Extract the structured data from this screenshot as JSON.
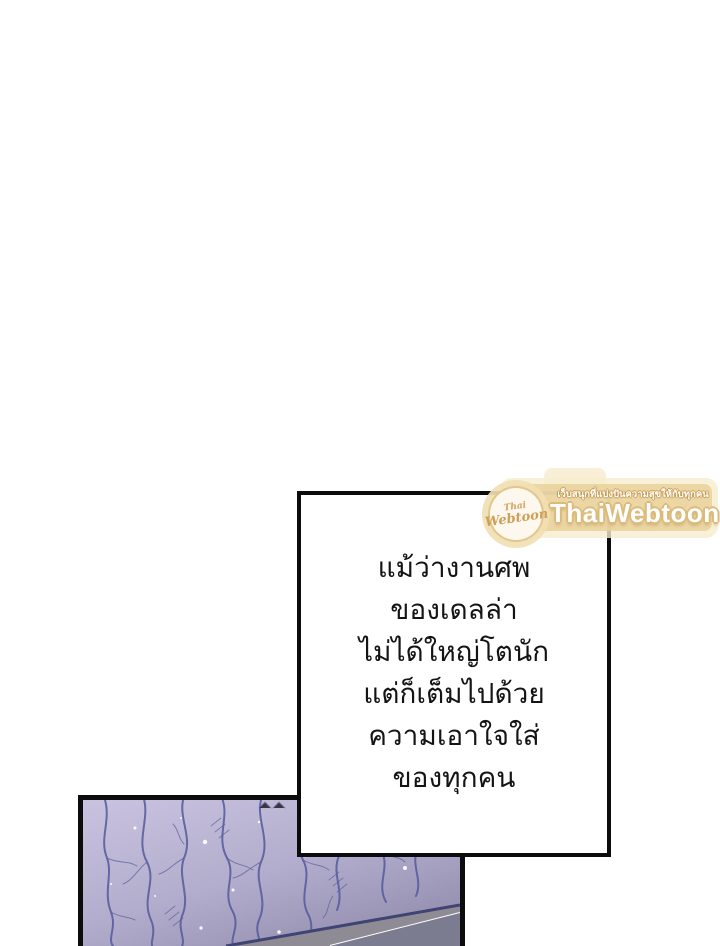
{
  "page": {
    "background_color": "#ffffff",
    "panel_border_color": "#0c0c0c"
  },
  "speech_box": {
    "lines": [
      "แม้ว่างานศพ",
      "ของเดลล่า",
      "ไม่ได้ใหญ่โตนัก",
      "แต่ก็เต็มไปด้วย",
      "ความเอาใจใส่",
      "ของทุกคน"
    ],
    "text_color": "#141414",
    "border_color": "#0c0c0c"
  },
  "watermark": {
    "logo_line1": "Thai",
    "logo_line2": "Webtoon",
    "tagline": "เว็บสนุกที่แบ่งปันความสุขให้กับทุกคน",
    "title": "ThaiWebtoon",
    "banner_color": "#e8d19d",
    "banner_light_color": "#f6eccd",
    "title_text_color": "#ffffff",
    "accent_color": "#d2a25e"
  },
  "art_panel": {
    "description": "cracked marble wall artwork",
    "base_color": "#c8c2df",
    "shade_color": "#938eae",
    "crack_color": "#545a9b",
    "band_color": "#8f8b94",
    "band_line_color": "#ffffff"
  }
}
